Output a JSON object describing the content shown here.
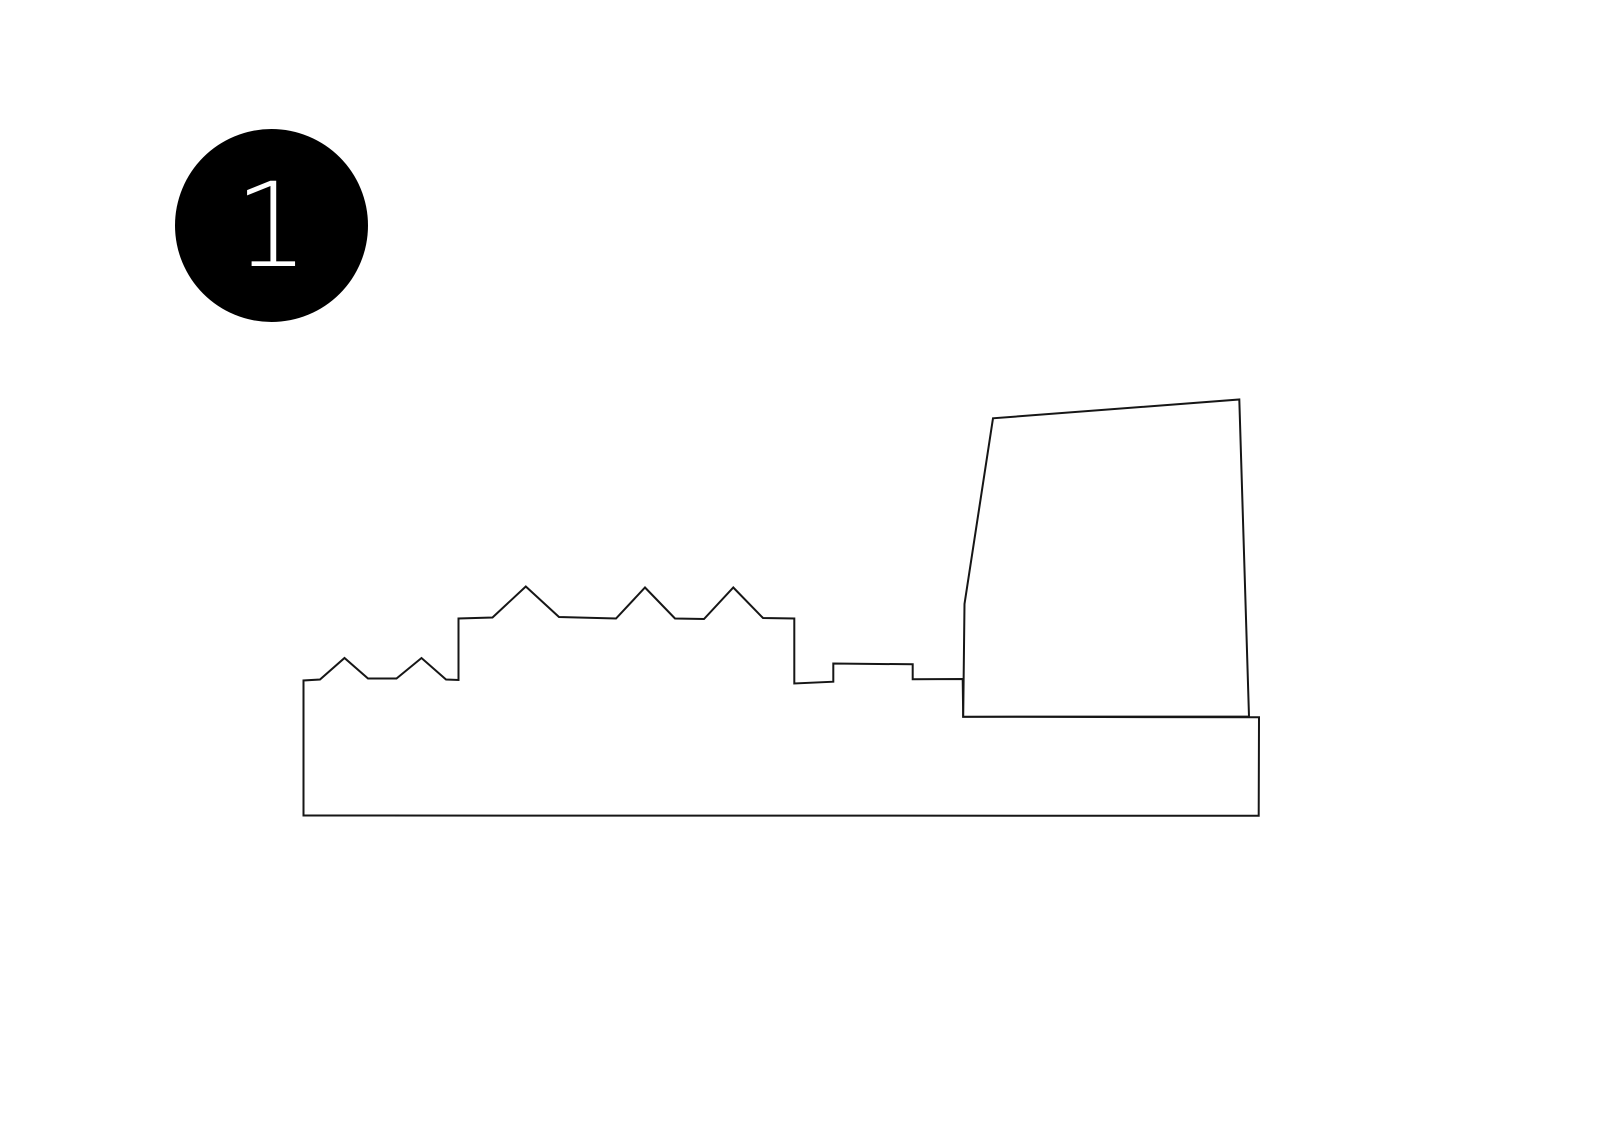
{
  "badge": {
    "number": "1",
    "bg": "#000000",
    "fg": "#ffffff"
  },
  "drawing": {
    "stroke": "#161616",
    "stroke_width": 2,
    "fill": "#ffffff",
    "shapes": [
      {
        "name": "skyline-outline",
        "points": [
          [
            303.5,
            815.5
          ],
          [
            303.5,
            680.5
          ],
          [
            320,
            679.5
          ],
          [
            344.5,
            658
          ],
          [
            368,
            678.5
          ],
          [
            396.5,
            678.5
          ],
          [
            421.5,
            658
          ],
          [
            446,
            679.5
          ],
          [
            458.5,
            680
          ],
          [
            458.5,
            618.5
          ],
          [
            492.5,
            617.5
          ],
          [
            525.8,
            586.5
          ],
          [
            559,
            617
          ],
          [
            616,
            618.5
          ],
          [
            645,
            587.5
          ],
          [
            675,
            618.5
          ],
          [
            704,
            619
          ],
          [
            733.3,
            587.5
          ],
          [
            763,
            618
          ],
          [
            794.3,
            618.5
          ],
          [
            794.3,
            683.5
          ],
          [
            833.3,
            681.7
          ],
          [
            833.3,
            663.5
          ],
          [
            912.7,
            664.3
          ],
          [
            912.7,
            679.3
          ],
          [
            962.7,
            679
          ],
          [
            963.2,
            716.7
          ],
          [
            1259,
            717.3
          ],
          [
            1258.7,
            815.8
          ]
        ]
      },
      {
        "name": "tower-block",
        "points": [
          [
            963.2,
            716.7
          ],
          [
            964.5,
            604
          ],
          [
            993,
            418.3
          ],
          [
            1239.3,
            399.5
          ],
          [
            1249,
            716.5
          ]
        ]
      }
    ]
  }
}
